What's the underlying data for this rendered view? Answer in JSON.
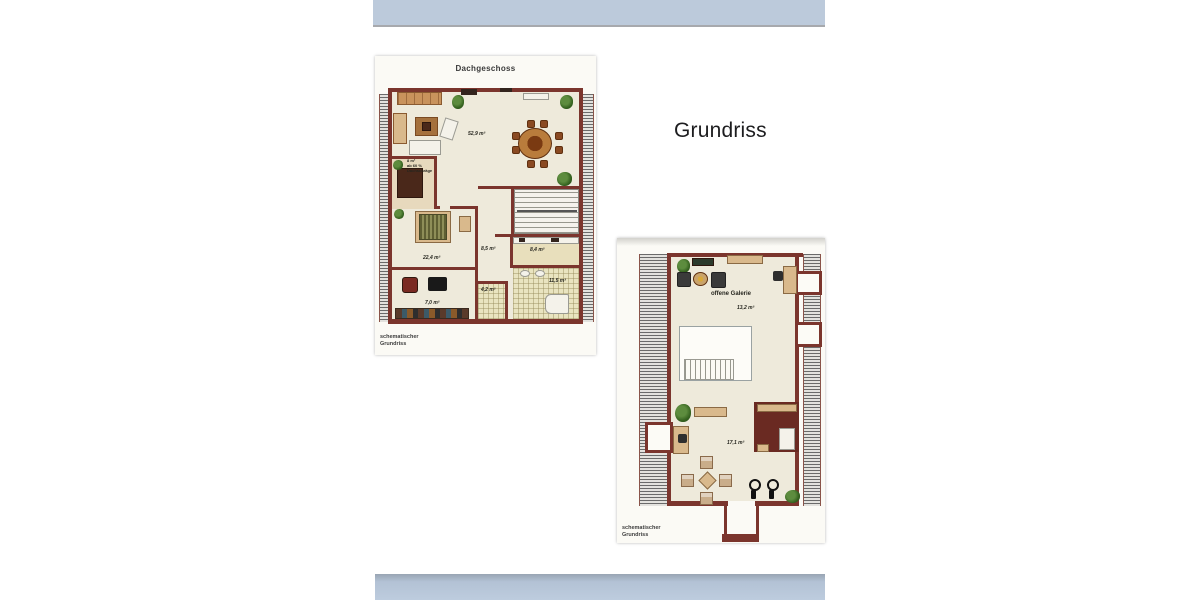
{
  "page": {
    "heading": "Grundriss"
  },
  "colors": {
    "top_band": "#bccadb",
    "bottom_band": "#bdccde",
    "wall": "#7b352d",
    "floor": "#eeeadb",
    "tile": "#e9e4c0",
    "photo_bg": "#fbfaf5"
  },
  "plan_dachgeschoss": {
    "title": "Dachgeschoss",
    "caption_l1": "schematischer",
    "caption_l2": "Grundriss",
    "labels": {
      "living": "52,9 m²",
      "slope_l1": "8 m²",
      "slope_l2": "ab 60 %",
      "slope_l3": "Dachschräge",
      "bedroom": "22,4 m²",
      "hall": "8,5 m²",
      "kitchen": "8,4 m²",
      "bath": "11,5 m²",
      "wc": "4,2 m²",
      "room_small": "7,0 m²"
    }
  },
  "plan_galerie": {
    "labels": {
      "gallery_name": "offene Galerie",
      "gallery_area": "13,2 m²",
      "room_area": "17,1 m²"
    },
    "caption_l1": "schematischer",
    "caption_l2": "Grundriss"
  }
}
